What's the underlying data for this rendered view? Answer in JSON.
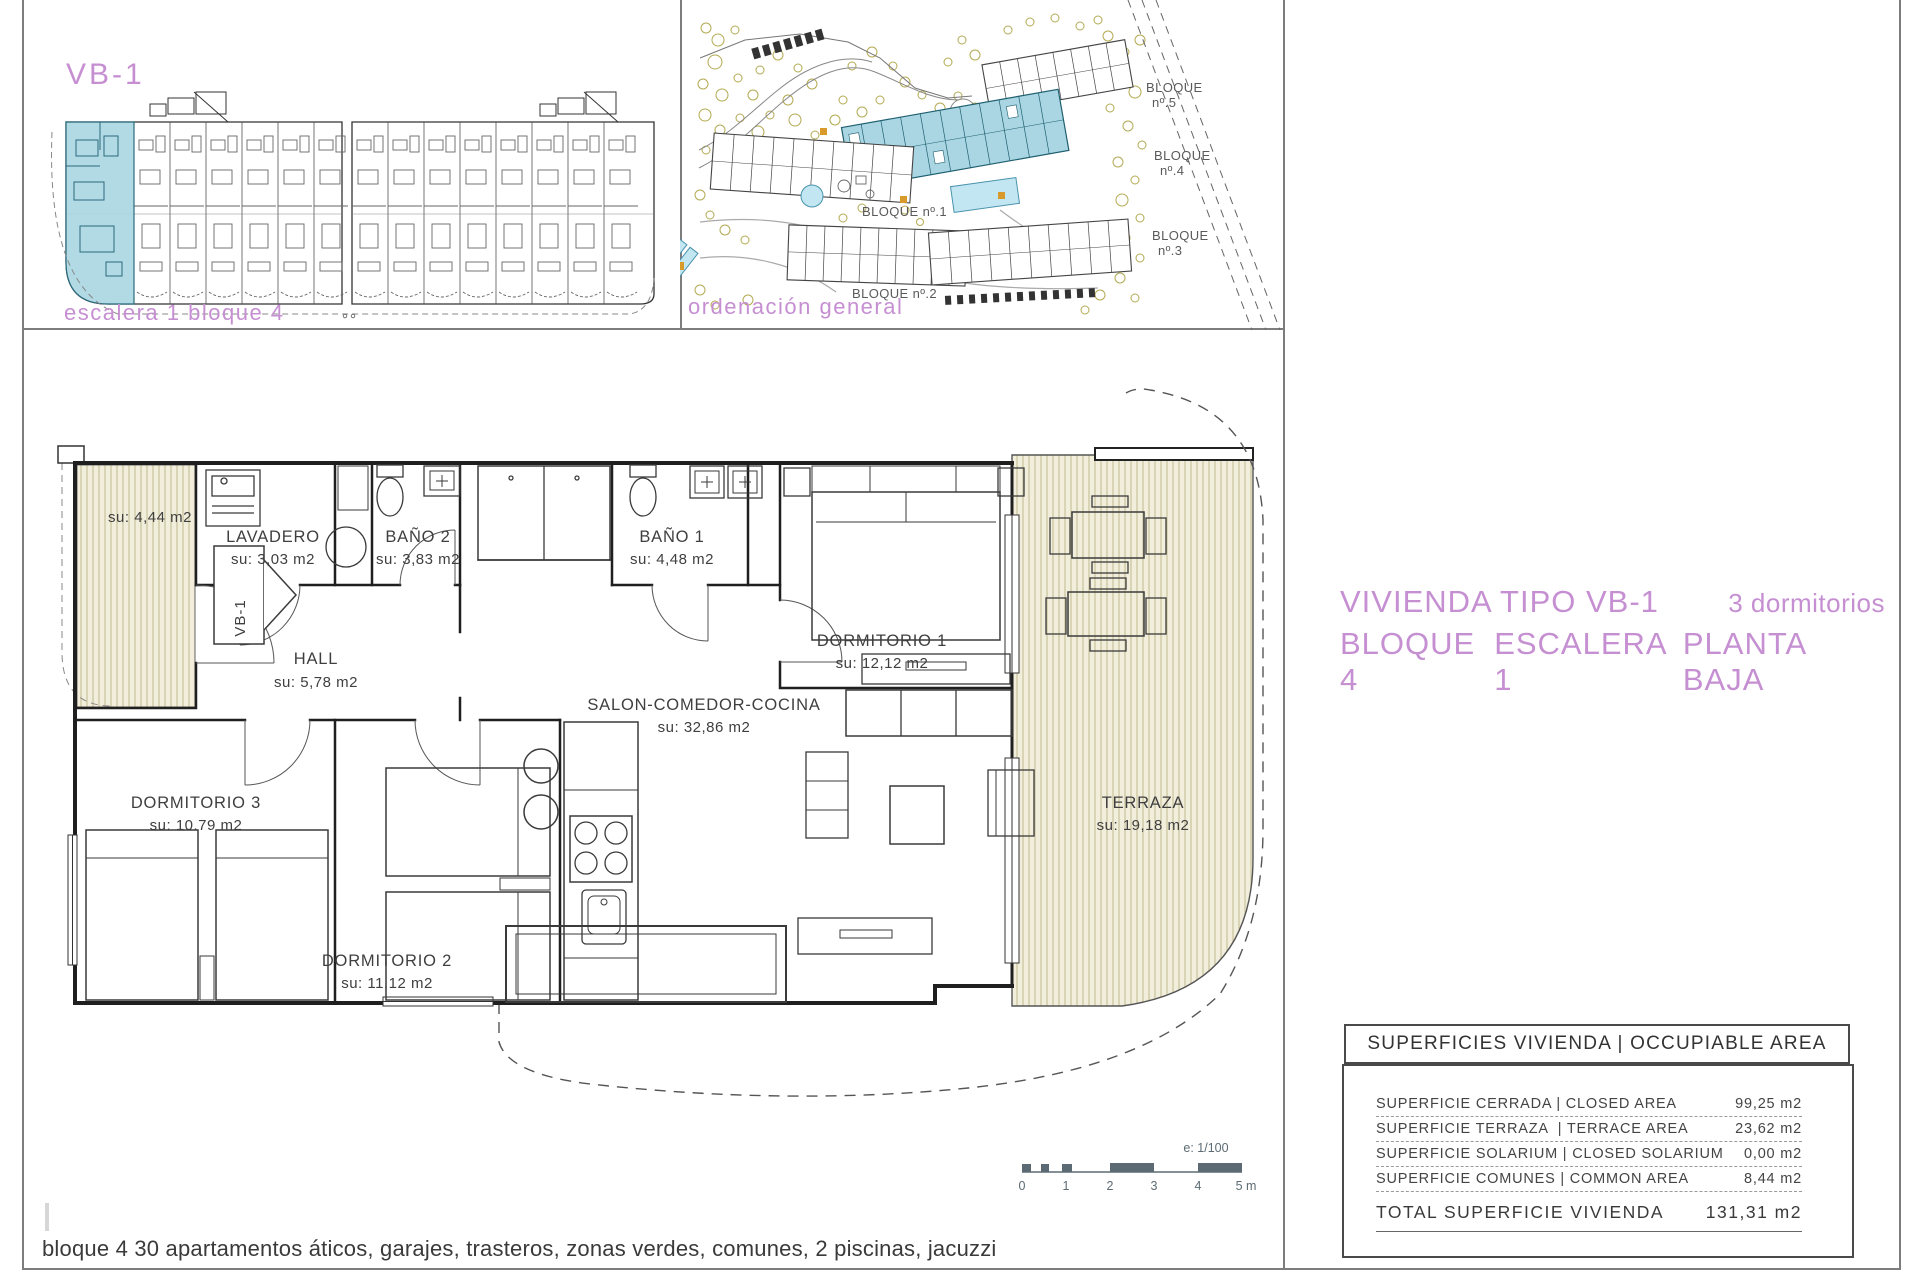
{
  "colors": {
    "accent": "#c58fd2",
    "highlight": "#a9d6e2"
  },
  "panel_escalera": {
    "tag": "VB-1",
    "caption": "escalera 1 bloque 4"
  },
  "panel_ordenacion": {
    "caption": "ordenación general",
    "bloque5_line1": "BLOQUE",
    "bloque5_line2": "nº.5",
    "bloque4_line1": "BLOQUE",
    "bloque4_line2": "nº.4",
    "bloque1": "BLOQUE nº.1",
    "bloque2": "BLOQUE nº.2",
    "bloque3_line1": "BLOQUE",
    "bloque3_line2": "nº.3"
  },
  "plan": {
    "entry_tag": "VB-1",
    "rooms": {
      "porche": {
        "area": "su: 4,44 m2"
      },
      "lavadero": {
        "name": "LAVADERO",
        "area": "su: 3,03 m2"
      },
      "bano2": {
        "name": "BAÑO 2",
        "area": "su: 3,83 m2"
      },
      "bano1": {
        "name": "BAÑO 1",
        "area": "su: 4,48 m2"
      },
      "hall": {
        "name": "HALL",
        "area": "su: 5,78 m2"
      },
      "dormitorio1": {
        "name": "DORMITORIO 1",
        "area": "su: 12,12 m2"
      },
      "salon": {
        "name": "SALON-COMEDOR-COCINA",
        "area": "su: 32,86 m2"
      },
      "dormitorio3": {
        "name": "DORMITORIO 3",
        "area": "su: 10.79 m2"
      },
      "dormitorio2": {
        "name": "DORMITORIO 2",
        "area": "su: 11,12 m2"
      },
      "terraza": {
        "name": "TERRAZA",
        "area": "su: 19,18 m2"
      }
    },
    "scalebar": {
      "note": "e: 1/100",
      "ticks": [
        "0",
        "1",
        "2",
        "3",
        "4",
        "5 m"
      ]
    }
  },
  "title": {
    "line1": "VIVIENDA TIPO VB-1",
    "line1_right": "3 dormitorios",
    "line2_part1": "BLOQUE 4",
    "line2_part2": "ESCALERA 1",
    "line2_part3": "PLANTA BAJA"
  },
  "area_table": {
    "header": "SUPERFICIES VIVIENDA | OCCUPIABLE AREA",
    "rows": [
      {
        "label": "SUPERFICIE CERRADA | CLOSED AREA",
        "value": "99,25 m2"
      },
      {
        "label": "SUPERFICIE TERRAZA  | TERRACE AREA",
        "value": "23,62 m2"
      },
      {
        "label": "SUPERFICIE SOLARIUM | CLOSED SOLARIUM",
        "value": "0,00 m2"
      },
      {
        "label": "SUPERFICIE COMUNES | COMMON AREA",
        "value": "8,44 m2"
      }
    ],
    "total_label": "TOTAL SUPERFICIE VIVIENDA",
    "total_value": "131,31 m2"
  },
  "footer": "bloque 4 30 apartamentos áticos, garajes, trasteros, zonas verdes, comunes, 2 piscinas, jacuzzi"
}
